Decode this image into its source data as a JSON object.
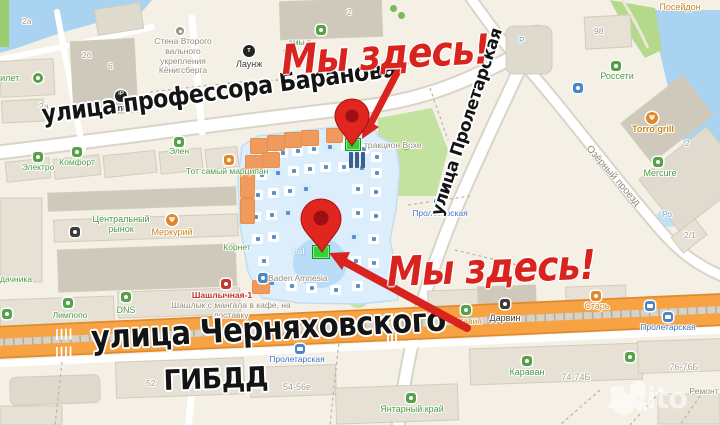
{
  "map": {
    "annotations": {
      "here_top": "Мы здесь!",
      "here_bottom": "Мы здесь!",
      "accent_red": "#d8231f",
      "marker_green": "#2fd435",
      "pin_icon": "map-pin-icon",
      "arrow_icon": "arrow-icon"
    },
    "streets": {
      "baranova": "улица профессора Баранова",
      "proletarskaya": "улица Пролетарская",
      "chernyakhovskogo": "улица Черняховского",
      "gibdd": "ГИБДД",
      "ozerny": "Озёрный проезд"
    },
    "watermark": "Avito",
    "colors": {
      "land": "#f4f0e6",
      "water": "#a9d3f1",
      "park": "#c3e2a0",
      "road_main": "#f7a243",
      "building": "#e6e1d4",
      "complex": "#dceefb"
    },
    "labels": [
      {
        "t": "тилет",
        "x": -4,
        "y": 73,
        "c": "green",
        "s": 9
      },
      {
        "t": "2а",
        "x": 22,
        "y": 17,
        "c": "num"
      },
      {
        "t": "2б",
        "x": 82,
        "y": 51,
        "c": "num"
      },
      {
        "t": "6",
        "x": 108,
        "y": 62,
        "c": "num"
      },
      {
        "t": "2а",
        "x": 39,
        "y": 102,
        "c": "num"
      },
      {
        "t": "Ipont",
        "x": 104,
        "y": 103,
        "c": "black",
        "s": 9,
        "b": 1
      },
      {
        "t": "Лаунж",
        "x": 236,
        "y": 59,
        "c": "black",
        "s": 9
      },
      {
        "t": "Стена Второго\nвального\nукрепления\nКёнигсберга",
        "x": 183,
        "y": 37,
        "c": "grey",
        "ctr": 1
      },
      {
        "t": "2",
        "x": 347,
        "y": 8,
        "c": "num"
      },
      {
        "t": "амы в",
        "x": 288,
        "y": 38,
        "c": "green"
      },
      {
        "t": "И",
        "x": 283,
        "y": 48,
        "c": "green"
      },
      {
        "t": "Посейдон",
        "x": 680,
        "y": 2,
        "c": "orange",
        "ctr": 1,
        "s": 9
      },
      {
        "t": "98",
        "x": 594,
        "y": 27,
        "c": "num"
      },
      {
        "t": "Россети",
        "x": 617,
        "y": 71,
        "c": "green",
        "ctr": 1,
        "s": 9
      },
      {
        "t": "Р",
        "x": 519,
        "y": 36,
        "c": "lblue"
      },
      {
        "t": "Torro grill",
        "x": 653,
        "y": 124,
        "c": "orange",
        "ctr": 1,
        "s": 9,
        "b": 1
      },
      {
        "t": "Mercure",
        "x": 660,
        "y": 168,
        "c": "green",
        "ctr": 1,
        "s": 9
      },
      {
        "t": "2",
        "x": 685,
        "y": 139,
        "c": "num"
      },
      {
        "t": "2/1",
        "x": 684,
        "y": 231,
        "c": "num"
      },
      {
        "t": "Ро",
        "x": 662,
        "y": 210,
        "c": "lblue"
      },
      {
        "t": "Электро",
        "x": 38,
        "y": 163,
        "c": "green",
        "ctr": 1
      },
      {
        "t": "Комфорт",
        "x": 77,
        "y": 158,
        "c": "green",
        "ctr": 1
      },
      {
        "t": "Элен",
        "x": 179,
        "y": 147,
        "c": "green",
        "ctr": 1
      },
      {
        "t": "Тот самый марципан",
        "x": 186,
        "y": 167,
        "c": "green"
      },
      {
        "t": "Центральный\nрынок",
        "x": 121,
        "y": 214,
        "c": "green",
        "ctr": 1,
        "s": 9
      },
      {
        "t": "Меркурий",
        "x": 172,
        "y": 227,
        "c": "orange",
        "ctr": 1,
        "s": 9
      },
      {
        "t": "Корнет",
        "x": 237,
        "y": 243,
        "c": "green",
        "ctr": 1
      },
      {
        "t": "тракцион Вохе",
        "x": 364,
        "y": 141,
        "c": "grey"
      },
      {
        "t": "Пролетарская",
        "x": 440,
        "y": 209,
        "c": "blue",
        "ctr": 1
      },
      {
        "t": "Пролетарская",
        "x": 297,
        "y": 355,
        "c": "blue",
        "ctr": 1
      },
      {
        "t": "Пролетарская",
        "x": 668,
        "y": 323,
        "c": "blue",
        "ctr": 1
      },
      {
        "t": "Baden Amnesia",
        "x": 268,
        "y": 274,
        "c": "grey"
      },
      {
        "t": "Шашлычная-1",
        "x": 222,
        "y": 291,
        "c": "red",
        "ctr": 1
      },
      {
        "t": "Шашлык с мангала в кафе, на\nдоставку",
        "x": 231,
        "y": 301,
        "c": "grey",
        "ctr": 1
      },
      {
        "t": "Лимпопо",
        "x": 70,
        "y": 311,
        "c": "green",
        "ctr": 1
      },
      {
        "t": "DNS",
        "x": 126,
        "y": 305,
        "c": "green",
        "ctr": 1,
        "s": 9
      },
      {
        "t": "дачника",
        "x": 0,
        "y": 275,
        "c": "green"
      },
      {
        "t": "bal",
        "x": 293,
        "y": 247,
        "c": "white"
      },
      {
        "t": "Октавия",
        "x": 449,
        "y": 317,
        "c": "orange"
      },
      {
        "t": "Дарвин",
        "x": 505,
        "y": 313,
        "c": "black",
        "ctr": 1,
        "s": 9
      },
      {
        "t": "Старь",
        "x": 597,
        "y": 301,
        "c": "orange",
        "ctr": 1,
        "s": 9
      },
      {
        "t": "Караван",
        "x": 527,
        "y": 367,
        "c": "green",
        "ctr": 1,
        "s": 9
      },
      {
        "t": "74-74Б",
        "x": 576,
        "y": 372,
        "c": "num",
        "ctr": 1,
        "s": 9
      },
      {
        "t": "76-76Б",
        "x": 684,
        "y": 362,
        "c": "num",
        "ctr": 1,
        "s": 9
      },
      {
        "t": "Ремонт",
        "x": 704,
        "y": 387,
        "c": "grey",
        "ctr": 1
      },
      {
        "t": "Янтарный край",
        "x": 412,
        "y": 404,
        "c": "green",
        "ctr": 1,
        "s": 9
      },
      {
        "t": "54-56е",
        "x": 297,
        "y": 382,
        "c": "num",
        "ctr": 1,
        "s": 9
      },
      {
        "t": "52",
        "x": 146,
        "y": 379,
        "c": "num"
      }
    ],
    "icons": [
      {
        "k": "ip",
        "x": 115,
        "y": 90
      },
      {
        "k": "t",
        "x": 243,
        "y": 45
      },
      {
        "k": "mon",
        "x": 176,
        "y": 27
      },
      {
        "k": "paw",
        "x": 33,
        "y": 73
      },
      {
        "k": "b",
        "x": 89,
        "y": 104
      },
      {
        "k": "tree",
        "x": 390,
        "y": 5
      },
      {
        "k": "tree",
        "x": 398,
        "y": 12
      },
      {
        "k": "g",
        "x": 316,
        "y": 25
      },
      {
        "k": "tree",
        "x": 403,
        "y": 143
      },
      {
        "k": "g",
        "x": 174,
        "y": 137
      },
      {
        "k": "g",
        "x": 72,
        "y": 147
      },
      {
        "k": "g",
        "x": 33,
        "y": 152
      },
      {
        "k": "o",
        "x": 224,
        "y": 155
      },
      {
        "k": "fork",
        "x": 166,
        "y": 214
      },
      {
        "k": "k",
        "x": 70,
        "y": 227
      },
      {
        "k": "g",
        "x": 2,
        "y": 309
      },
      {
        "k": "g",
        "x": 63,
        "y": 298
      },
      {
        "k": "g",
        "x": 121,
        "y": 292
      },
      {
        "k": "r",
        "x": 221,
        "y": 279
      },
      {
        "k": "b",
        "x": 258,
        "y": 273
      },
      {
        "k": "fork",
        "x": 646,
        "y": 112
      },
      {
        "k": "g",
        "x": 611,
        "y": 61
      },
      {
        "k": "b",
        "x": 573,
        "y": 83
      },
      {
        "k": "g",
        "x": 653,
        "y": 157
      },
      {
        "k": "g",
        "x": 461,
        "y": 305
      },
      {
        "k": "k",
        "x": 500,
        "y": 299
      },
      {
        "k": "o",
        "x": 591,
        "y": 291
      },
      {
        "k": "g",
        "x": 522,
        "y": 356
      },
      {
        "k": "g",
        "x": 406,
        "y": 393
      },
      {
        "k": "g",
        "x": 625,
        "y": 352
      },
      {
        "k": "bus",
        "x": 434,
        "y": 198
      },
      {
        "k": "bus",
        "x": 295,
        "y": 344
      },
      {
        "k": "bus",
        "x": 645,
        "y": 301
      },
      {
        "k": "bus",
        "x": 663,
        "y": 312
      }
    ]
  }
}
